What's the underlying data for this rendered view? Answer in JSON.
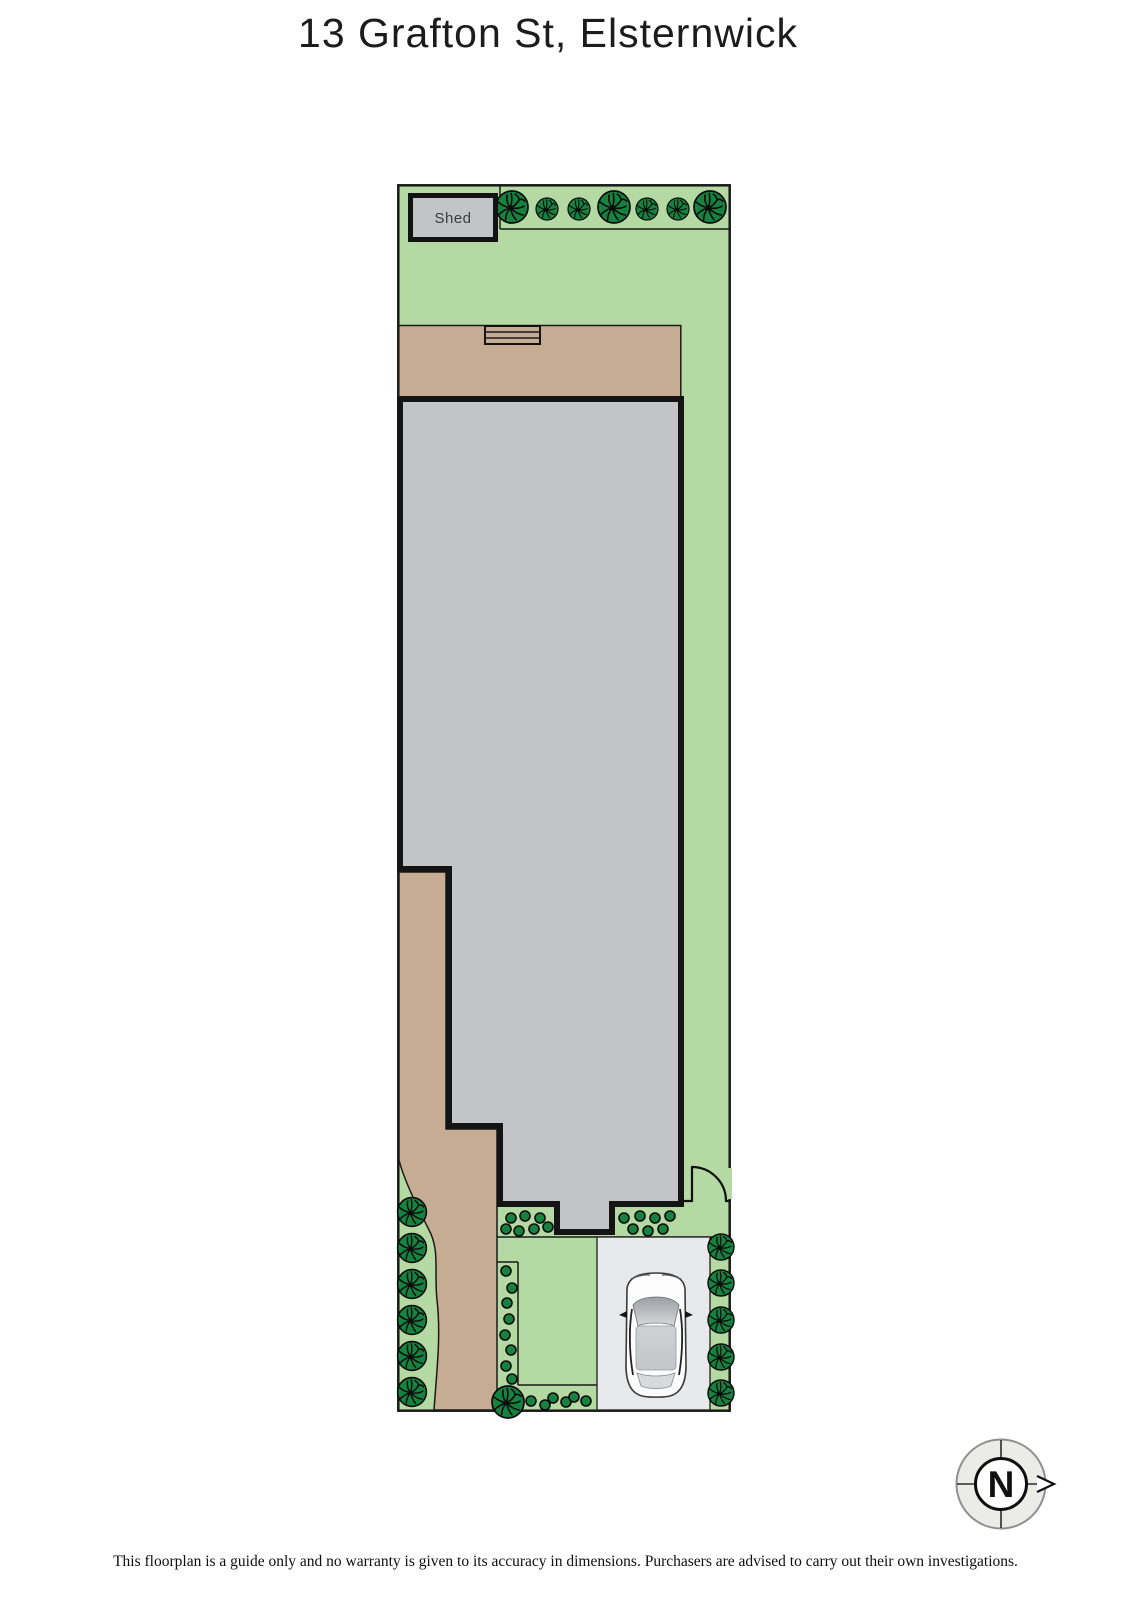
{
  "title": "13 Grafton St, Elsternwick",
  "plan": {
    "shed_label": "Shed"
  },
  "compass": {
    "north_label": "N",
    "north_direction": "right"
  },
  "disclaimer": "This floorplan is a guide only and no warranty is given to its accuracy in dimensions. Purchasers are advised to carry out their own investigations.",
  "colors": {
    "site_green": "#b5d9a2",
    "foliage_green": "#17823f",
    "path_tan": "#c6ac93",
    "house_gray": "#c2c4c6",
    "shed_gray": "#c2c4c6",
    "driveway_gray": "#e8e9ea",
    "outline_black": "#1a1a1a",
    "compass_fill": "#ebece8"
  }
}
